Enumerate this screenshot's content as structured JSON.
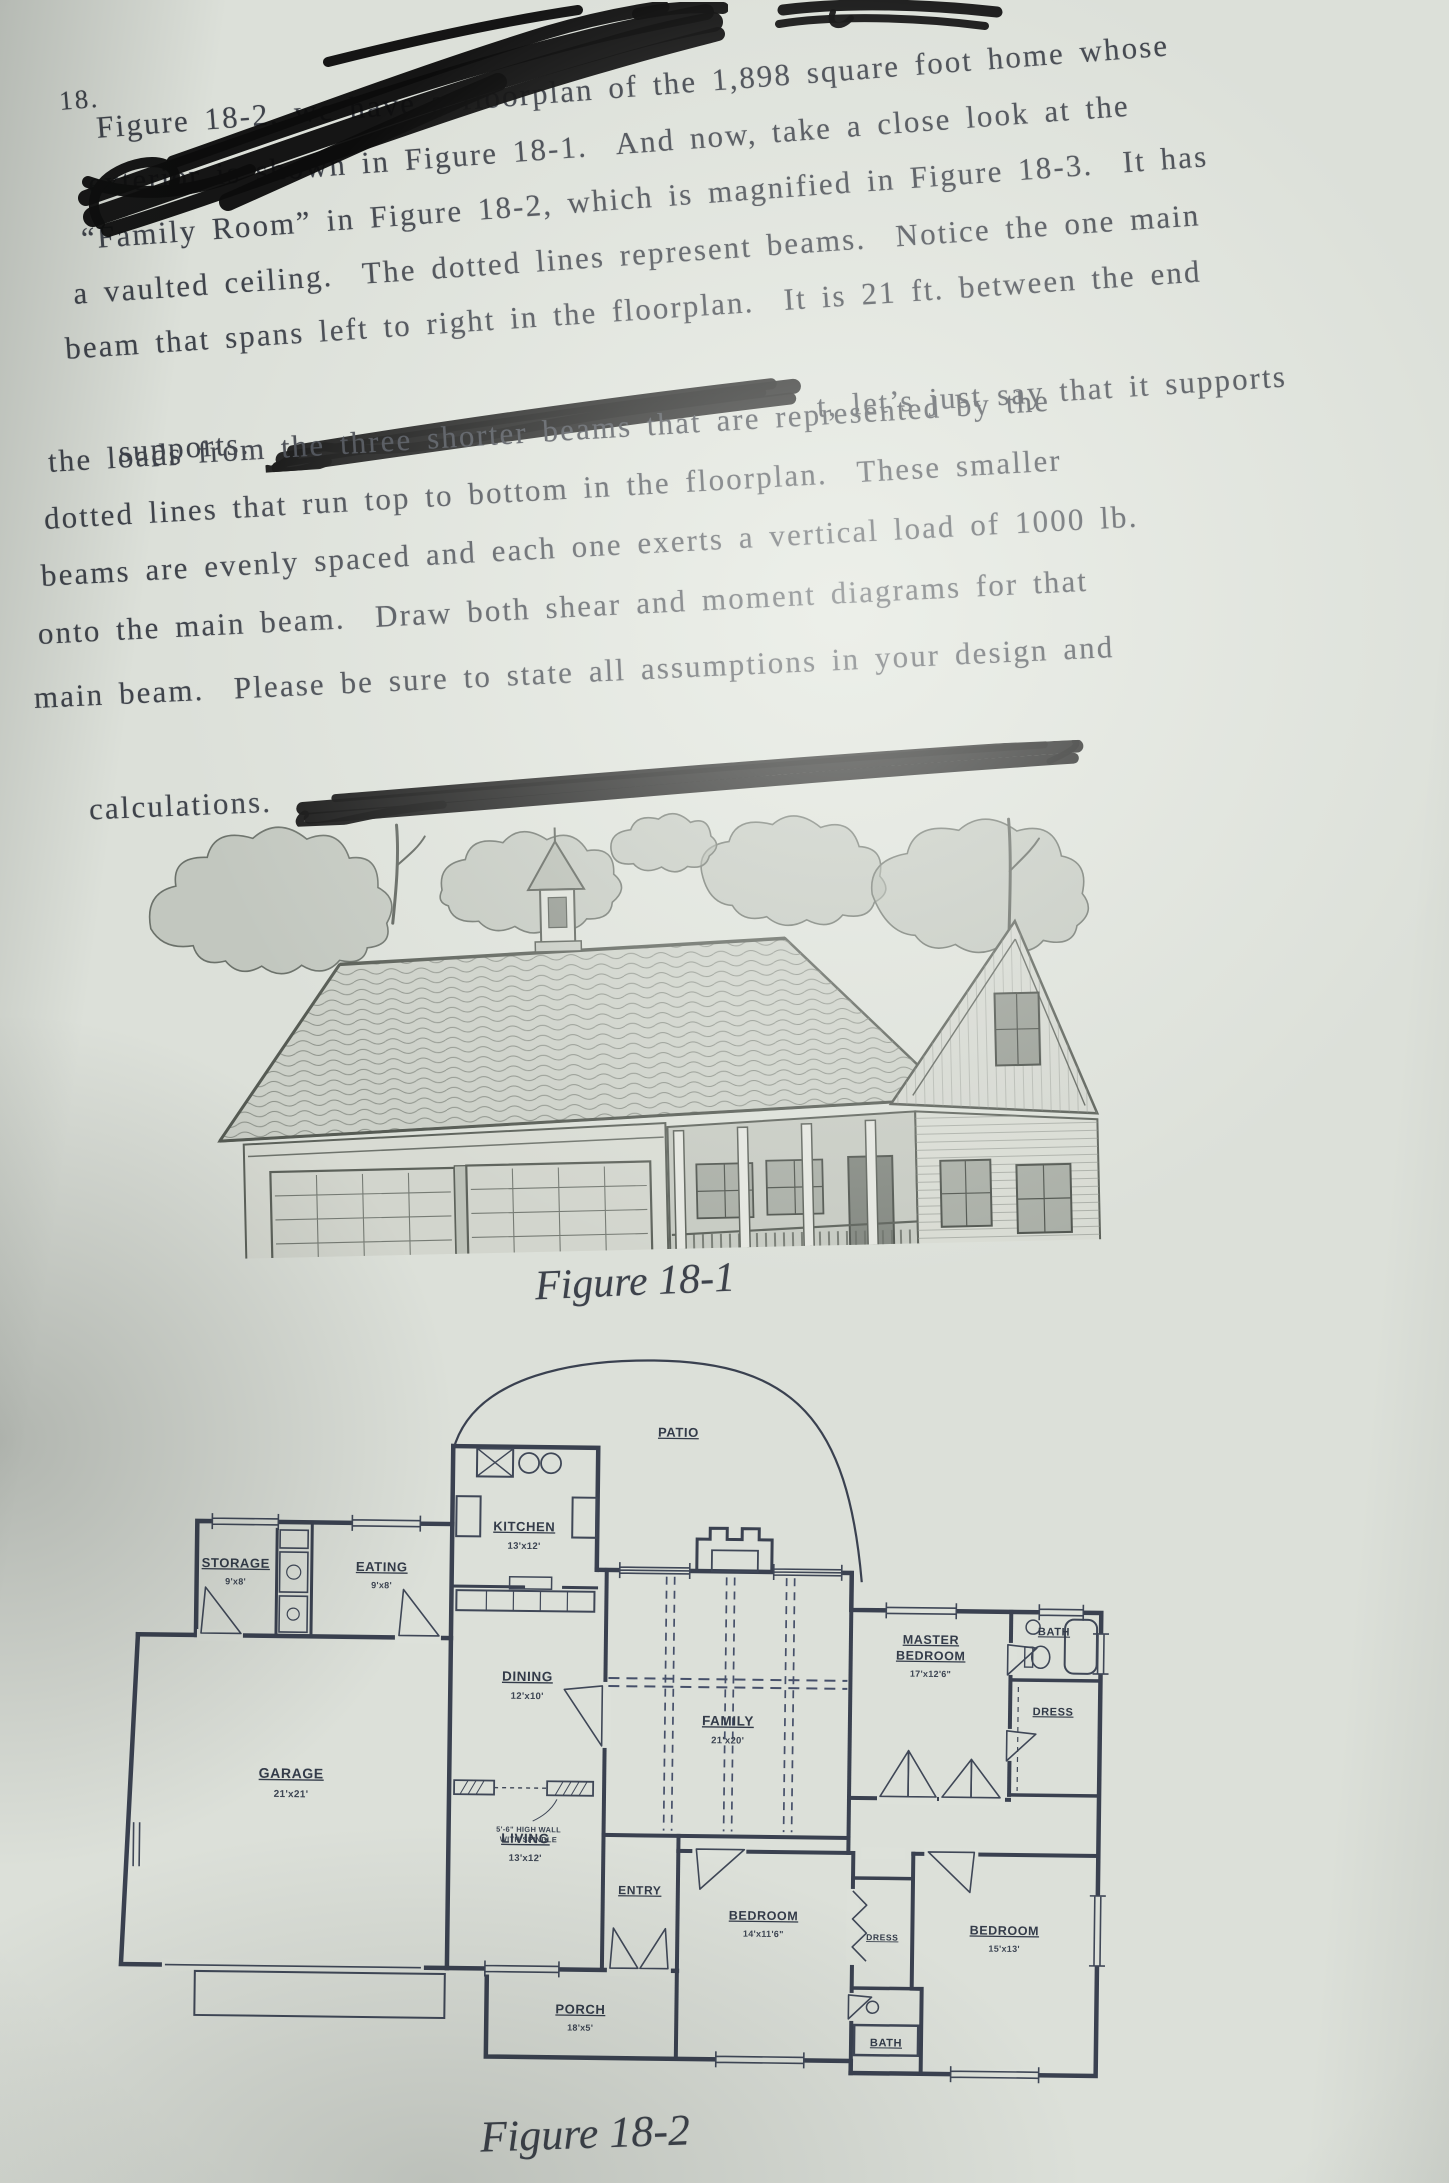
{
  "problem": {
    "number": "18.",
    "lines": {
      "l1": "Figure 18-2, we have a floorplan of the 1,898 square foot home whose",
      "l2": "exterior is shown in Figure 18-1.  And now, take a close look at the",
      "l3": "“Family Room” in Figure 18-2, which is magnified in Figure 18-3.  It has",
      "l4": "a vaulted ceiling.  The dotted lines represent beams.  Notice the one main",
      "l5": "beam that spans left to right in the floorplan.  It is 21 ft. between the end",
      "l6_pre": "supports.",
      "l6_post": "t, let’s just say that it supports",
      "l7": "the loads from the three shorter beams that are represented by the",
      "l8": "dotted lines that run top to bottom in the floorplan.  These smaller",
      "l9": "beams are evenly spaced and each one exerts a vertical load of 1000 lb.",
      "l10": "onto the main beam.  Draw both shear and moment diagrams for that",
      "l11": "main beam.  Please be sure to state all assumptions in your design and",
      "l12": "calculations."
    }
  },
  "figures": {
    "fig1_caption": "Figure 18-1",
    "fig2_caption": "Figure 18-2"
  },
  "floorplan": {
    "patio": "PATIO",
    "kitchen": "KITCHEN",
    "kitchen_dims": "13'x12'",
    "storage": "STORAGE",
    "storage_dims": "9'x8'",
    "eating": "EATING",
    "eating_dims": "9'x8'",
    "garage": "GARAGE",
    "garage_dims": "21'x21'",
    "dining": "DINING",
    "dining_dims": "12'x10'",
    "living": "LIVING",
    "living_dims": "13'x12'",
    "family": "FAMILY",
    "family_dims": "21'x20'",
    "master_line1": "MASTER",
    "master_line2": "BEDROOM",
    "master_dims": "17'x12'6\"",
    "bath_top": "BATH",
    "dress_right": "DRESS",
    "entry": "ENTRY",
    "porch": "PORCH",
    "porch_dims": "18'x5'",
    "bedroom_front": "BEDROOM",
    "bedroom_front_dims": "14'x11'6\"",
    "dress_small": "DRESS",
    "bedroom_rear": "BEDROOM",
    "bedroom_rear_dims": "15'x13'",
    "bath_bottom": "BATH",
    "half_wall_note1": "5'-6\" HIGH WALL",
    "half_wall_note2": "WITH SPINDLE"
  },
  "colors": {
    "paper": "#dce0d9",
    "text_ink": "#3f434b",
    "plan_ink": "#3a4150",
    "marker": "#0c0c0c",
    "sketch_ink": "#5b605a"
  }
}
